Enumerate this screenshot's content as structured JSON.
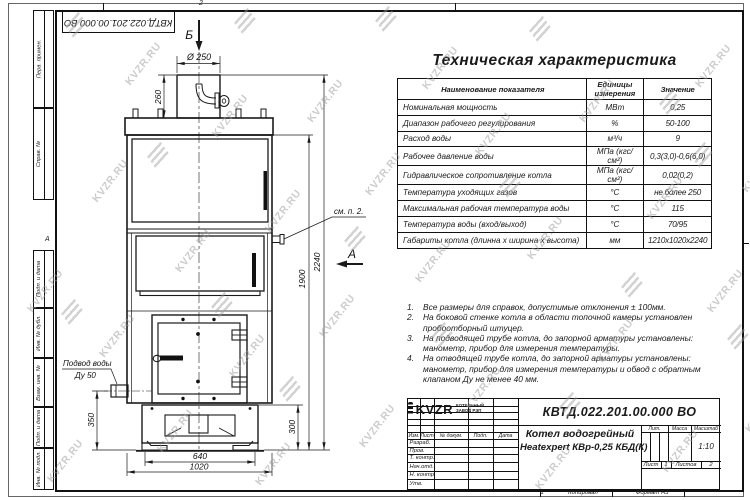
{
  "watermark": {
    "text": "KVZR.RU"
  },
  "colors": {
    "line": "#1a1a1a",
    "paper": "#ffffff",
    "watermark": "#9b9b9b"
  },
  "corner_stamp": {
    "doc_number": "КВТД.022.201.00.000 ВО"
  },
  "margin": {
    "labels": [
      "Перв. примен.",
      "Справ. №",
      "Подп. и дата",
      "Инв. № дубл.",
      "Взам. инв. №",
      "Подп. и дата",
      "Инв. № подл."
    ],
    "zone_letter": "А",
    "top_zone": "2",
    "bottom_zone": "1"
  },
  "spec_table": {
    "title": "Техническая характеристика",
    "headers": [
      "Наименование показателя",
      "Единицы измерения",
      "Значение"
    ],
    "rows": [
      {
        "name": "Номинальная мощность",
        "unit": "МВт",
        "value": "0,25"
      },
      {
        "name": "Диапазон рабочего регулирования",
        "unit": "%",
        "value": "50-100"
      },
      {
        "name": "Расход воды",
        "unit": "м³/ч",
        "value": "9"
      },
      {
        "name": "Рабочее давление воды",
        "unit": "МПа (кгс/см²)",
        "value": "0,3(3,0)-0,6(6,0)"
      },
      {
        "name": "Гидравлическое сопротивление котла",
        "unit": "МПа (кгс/см²)",
        "value": "0,02(0,2)"
      },
      {
        "name": "Температура уходящих газов",
        "unit": "°С",
        "value": "не более 250"
      },
      {
        "name": "Максимальная рабочая температура воды",
        "unit": "°С",
        "value": "115"
      },
      {
        "name": "Температура воды (вход/выход)",
        "unit": "°С",
        "value": "70/95"
      },
      {
        "name": "Габариты котла (длинна х ширина х высота)",
        "unit": "мм",
        "value": "1210х1020х2240"
      }
    ]
  },
  "notes": {
    "items": [
      {
        "n": "1.",
        "text": "Все размеры для справок, допустимые отклонения ± 100мм."
      },
      {
        "n": "2.",
        "text": "На боковой стенке котла в области топочной камеры установлен пробоотборный штуцер."
      },
      {
        "n": "3.",
        "text": "На подводящей трубе котла, до запорной арматуры установлены: манометр, прибор для измерения температуры."
      },
      {
        "n": "4.",
        "text": "На отводящей трубе котла, до запорной арматуры установлены: манометр, прибор для измерения температуры и обвод с обратным клапаном Ду не менее 40 мм."
      }
    ]
  },
  "drawing": {
    "view_top": "Б",
    "view_side": "А",
    "see_note": "см. п. 2.",
    "dim_flue_dia": "Ø 250",
    "dim_flue_h": "260",
    "dim_h_total": "2240",
    "dim_h_body": "1900",
    "dim_inlet_h": "350",
    "dim_base_h": "300",
    "dim_base_w": "640",
    "dim_w_total": "1020",
    "inlet_label1": "Подвод воды",
    "inlet_label2": "Ду 50"
  },
  "title_block": {
    "doc_number": "КВТД.022.201.00.000 ВО",
    "name_line1": "Котел водогрейный",
    "name_line2": "Heatexpert КВр-0,25 КБД(К)",
    "cols": [
      "Изм.",
      "Лист",
      "№ докум.",
      "Подп.",
      "Дата"
    ],
    "rows": [
      "Разраб.",
      "Пров.",
      "Т. контр.",
      "Нач.отд.",
      "Н. контр.",
      "Утв."
    ],
    "lit_label": "Лит.",
    "mass_label": "Масса",
    "scale_label": "Масштаб",
    "scale_value": "1:10",
    "sheet_label": "Лист",
    "sheet_value": "1",
    "sheets_label": "Листов",
    "sheets_value": "2",
    "company": {
      "abbr": "KVZR",
      "sub1": "КОТЕЛЬНЫЙ",
      "sub2": "ЗАВОД РЭП"
    },
    "footer": {
      "copy_label": "Копировал",
      "format_label": "Формат А3"
    }
  }
}
